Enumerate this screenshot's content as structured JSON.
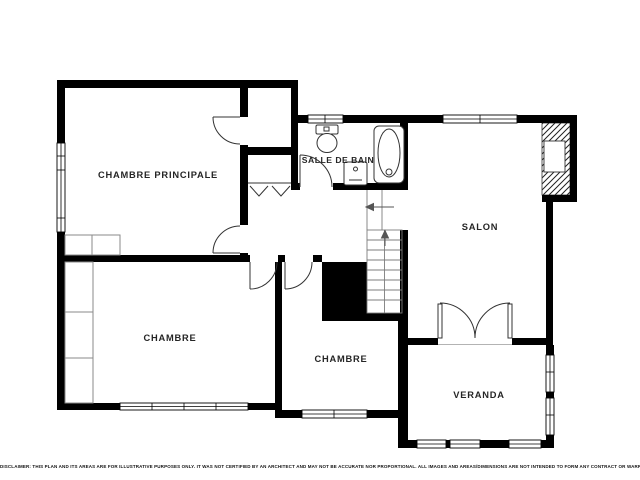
{
  "title": {
    "number": "2",
    "superscript": "E",
    "word": "ÉTAGE"
  },
  "rooms": {
    "master_bedroom": {
      "label": "CHAMBRE PRINCIPALE"
    },
    "bathroom": {
      "label": "SALLE DE BAIN"
    },
    "salon": {
      "label": "SALON"
    },
    "bedroom_left": {
      "label": "CHAMBRE"
    },
    "bedroom_center": {
      "label": "CHAMBRE"
    },
    "veranda": {
      "label": "VERANDA"
    }
  },
  "footer": {
    "disclaimer": "DISCLAIMER: THIS PLAN AND ITS AREAS ARE FOR ILLUSTRATIVE PURPOSES ONLY. IT WAS NOT CERTIFIED BY AN ARCHITECT AND MAY NOT BE ACCURATE NOR PROPORTIONAL. ALL IMAGES AND AREAS/DIMENSIONS ARE NOT INTENDED TO FORM ANY CONTRACT OR WARRANTY."
  },
  "colors": {
    "walls": "#000000",
    "background": "#ffffff",
    "fixtures": "#333333"
  }
}
